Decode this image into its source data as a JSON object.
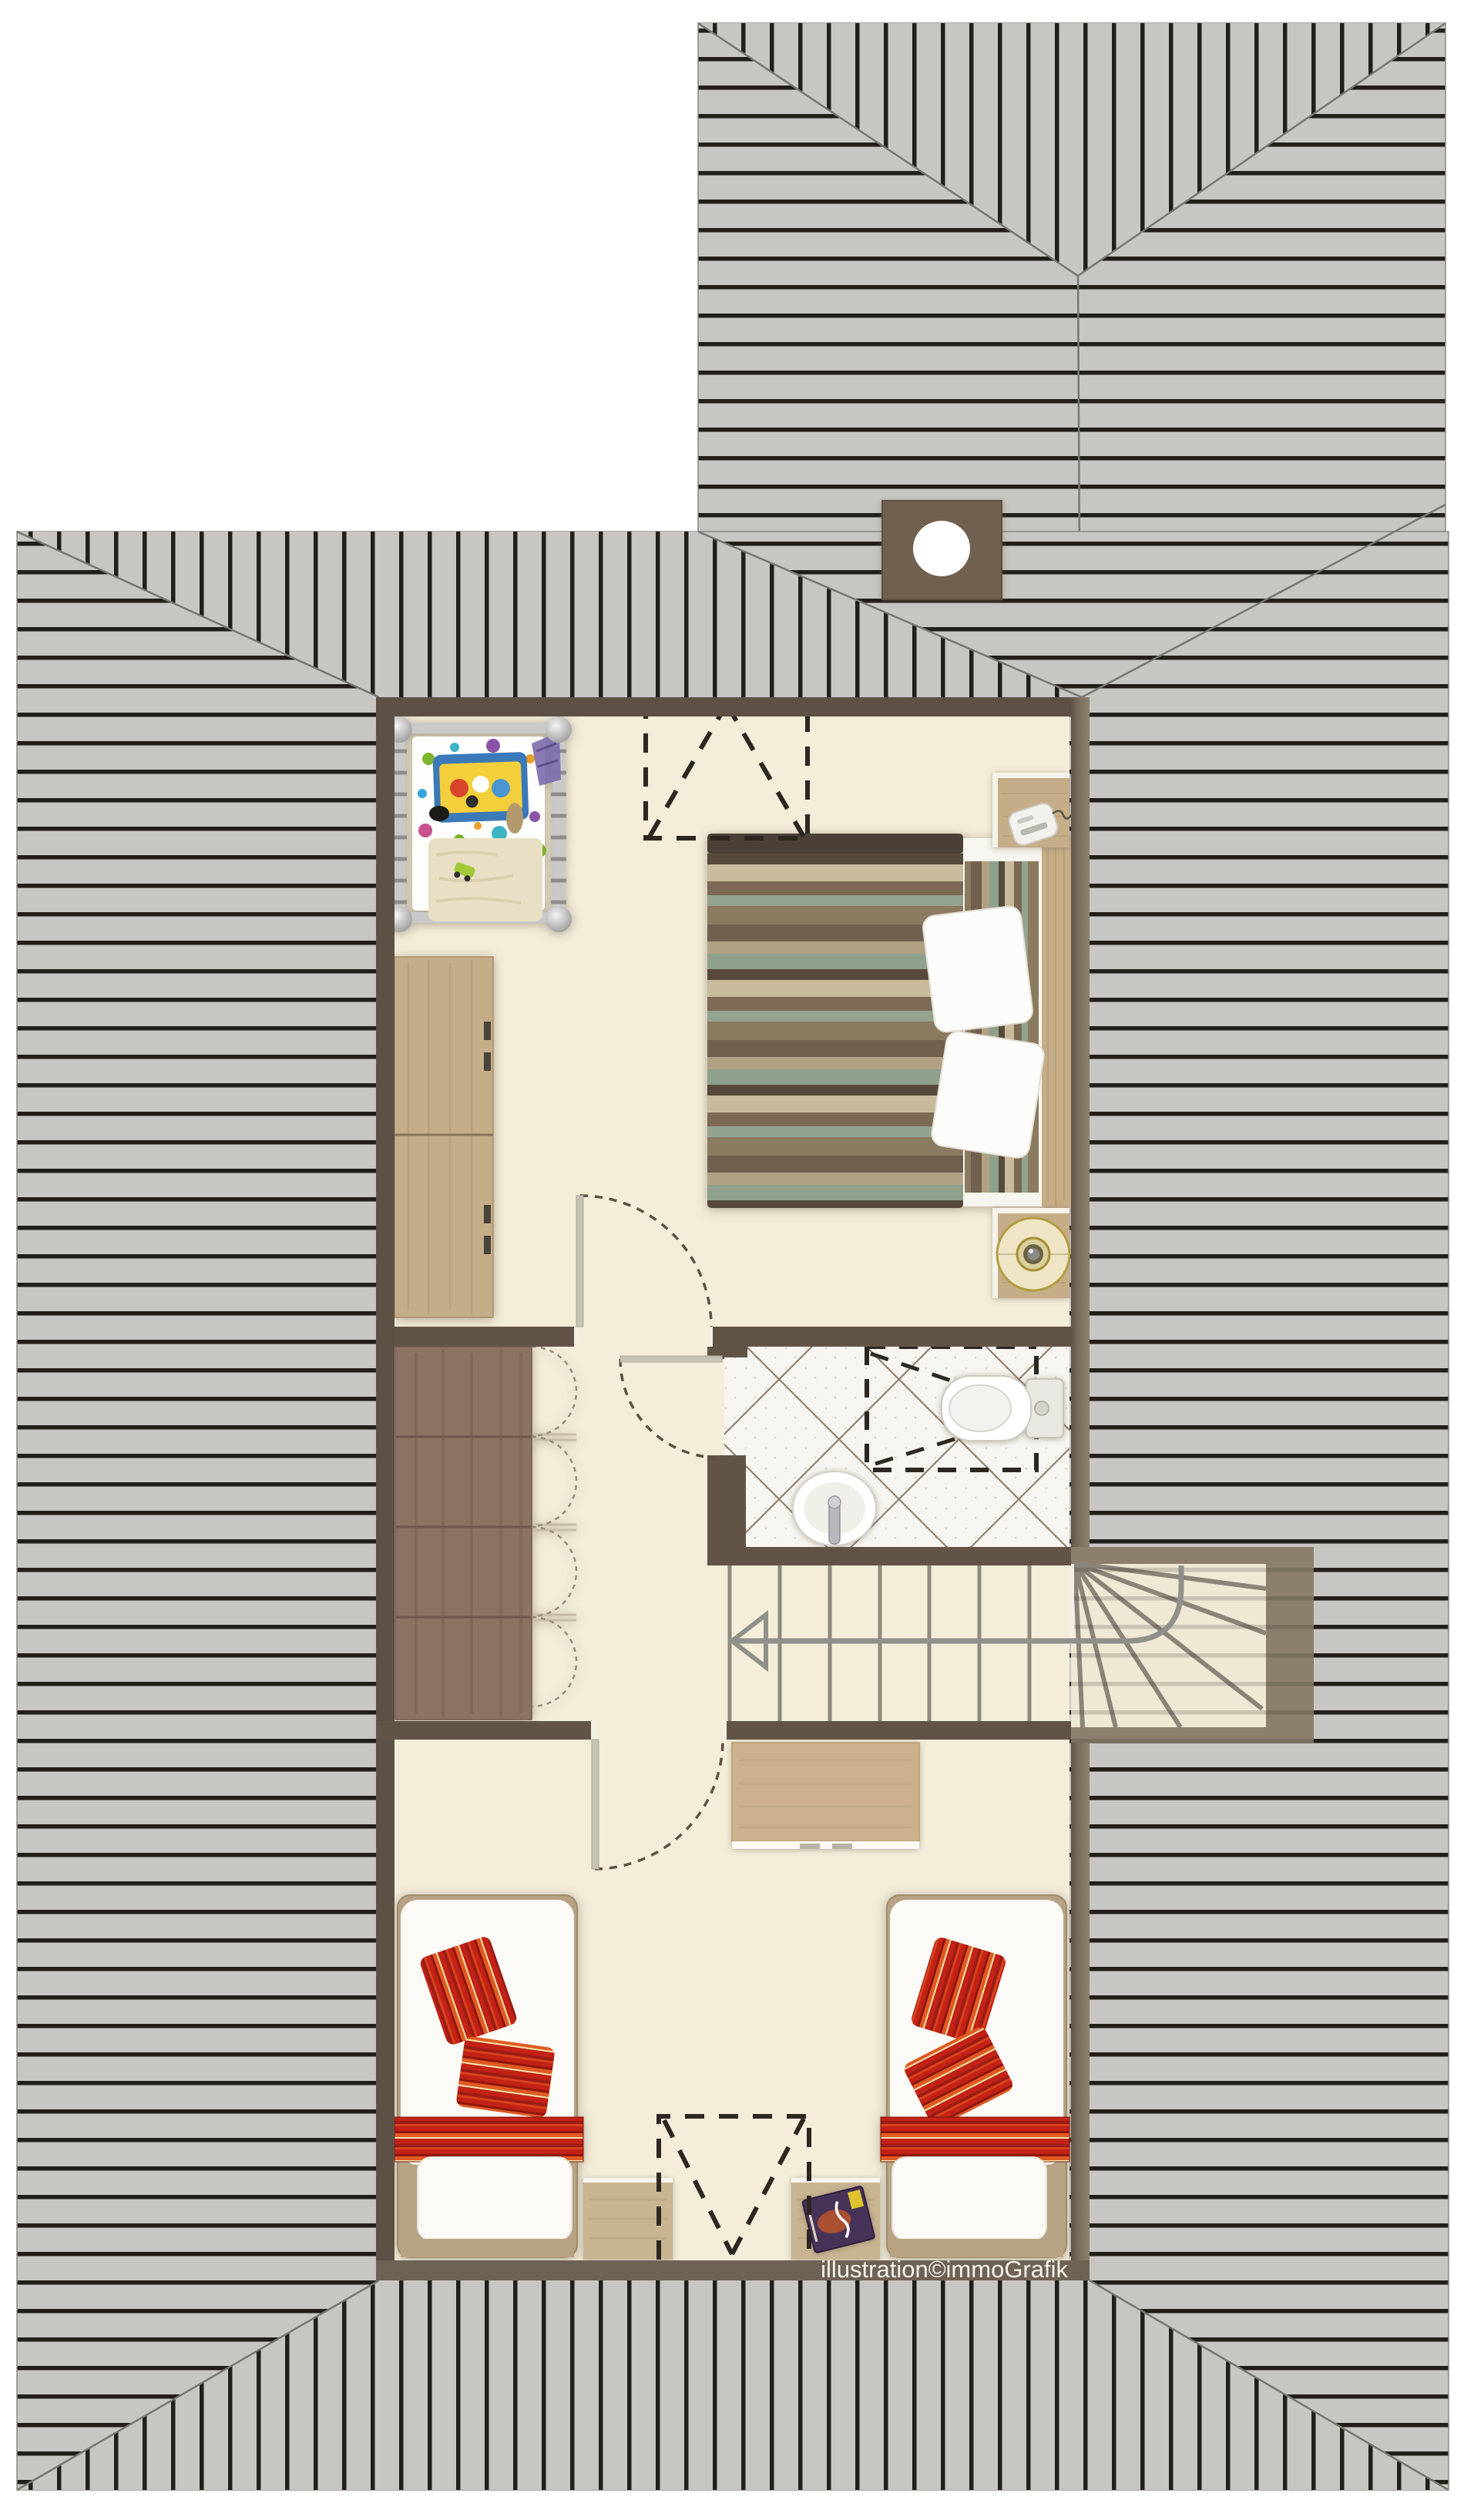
{
  "watermark": "illustration©immoGrafik",
  "drawing": {
    "type": "floor-plan",
    "view": "top-down attic storey with hip roof",
    "rooms": [
      "bedroom",
      "hallway",
      "bathroom",
      "stairwell",
      "lounge-room"
    ],
    "furniture": [
      "crib",
      "double-bed",
      "nightstand-with-phone",
      "nightstand-with-lamp",
      "wardrobe-oak",
      "wardrobe-walnut",
      "shower-dashed-outline",
      "toilet",
      "sink",
      "staircase-with-winders",
      "desk",
      "single-bed-left",
      "single-bed-right",
      "bench-left",
      "bench-right",
      "magazine",
      "roof-window-top",
      "roof-window-bottom",
      "chimney"
    ]
  },
  "colors": {
    "roof_field": "#c7c6c3",
    "roof_line": "#221e19",
    "roof_ridge": "#77766f",
    "wall_dark": "#5d5146",
    "wall_inner": "#615447",
    "wall_bottom": "#6e6255",
    "wall_light": "#8d7f6e",
    "floor": "#f3edda",
    "floor_fan": "#eee8d5",
    "tile_base": "#f7f5f1",
    "tile_grout": "#8b7867",
    "wood_oak": "#c5ad87",
    "wood_walnut": "#8d7164",
    "wood_light": "#cbb28c",
    "frame_wood": "#b7a384",
    "red_base": "#c32318",
    "white_soft": "#fbfaf7",
    "chimney": "#6f6050",
    "gold": "#b39d42",
    "dash_dark": "#2c2720",
    "door_dash": "#5d5044",
    "stair_line": "#8e897e",
    "walk_line": "#90908a",
    "text_color": "#f5f2ea"
  }
}
